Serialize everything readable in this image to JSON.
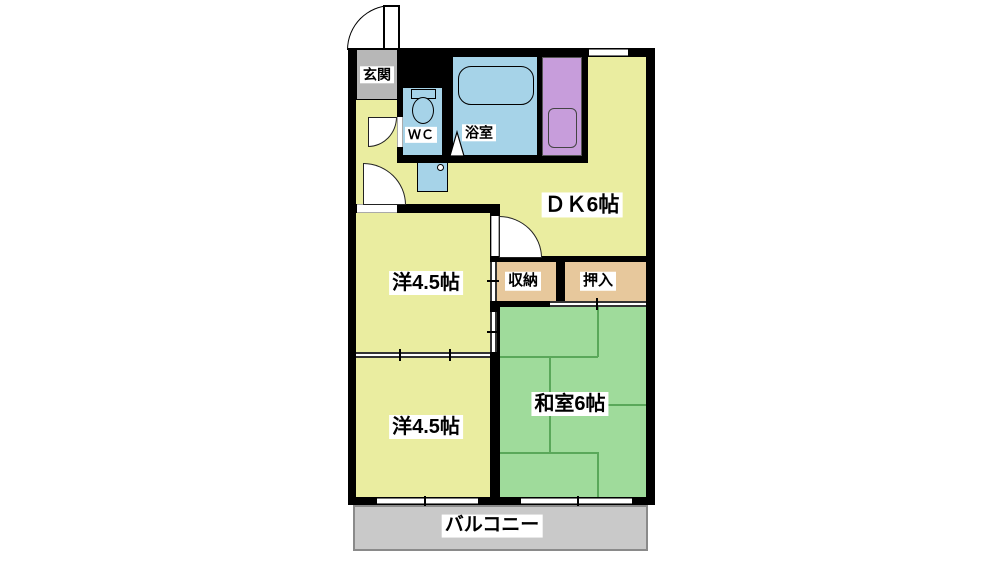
{
  "plan_title": "2DK apartment floor plan",
  "rooms": {
    "genkan": {
      "label": "玄関"
    },
    "wc": {
      "label": "ＷＣ"
    },
    "bath": {
      "label": "浴室"
    },
    "dk": {
      "label": "ＤＫ6帖"
    },
    "western_upper": {
      "label": "洋4.5帖"
    },
    "western_lower": {
      "label": "洋4.5帖"
    },
    "storage": {
      "label": "収納"
    },
    "oshiire": {
      "label": "押入"
    },
    "washitsu": {
      "label": "和室6帖"
    },
    "balcony": {
      "label": "バルコニー"
    }
  },
  "fixtures": [
    "entrance-door",
    "toilet",
    "bathtub",
    "kitchen-sink",
    "washbasin",
    "bath-folding-door"
  ],
  "colors": {
    "wall": "#000000",
    "floor_yellow": "#eaeda0",
    "tatami_green": "#9fdb9b",
    "tatami_line": "#5aa85a",
    "water_blue": "#a6d3e8",
    "kitchen_purple": "#c79ddb",
    "closet_tan": "#e7c89c",
    "genkan_gray": "#b7b7b7",
    "balcony_gray": "#c9c9c9",
    "balcony_border": "#8a8a8a"
  }
}
